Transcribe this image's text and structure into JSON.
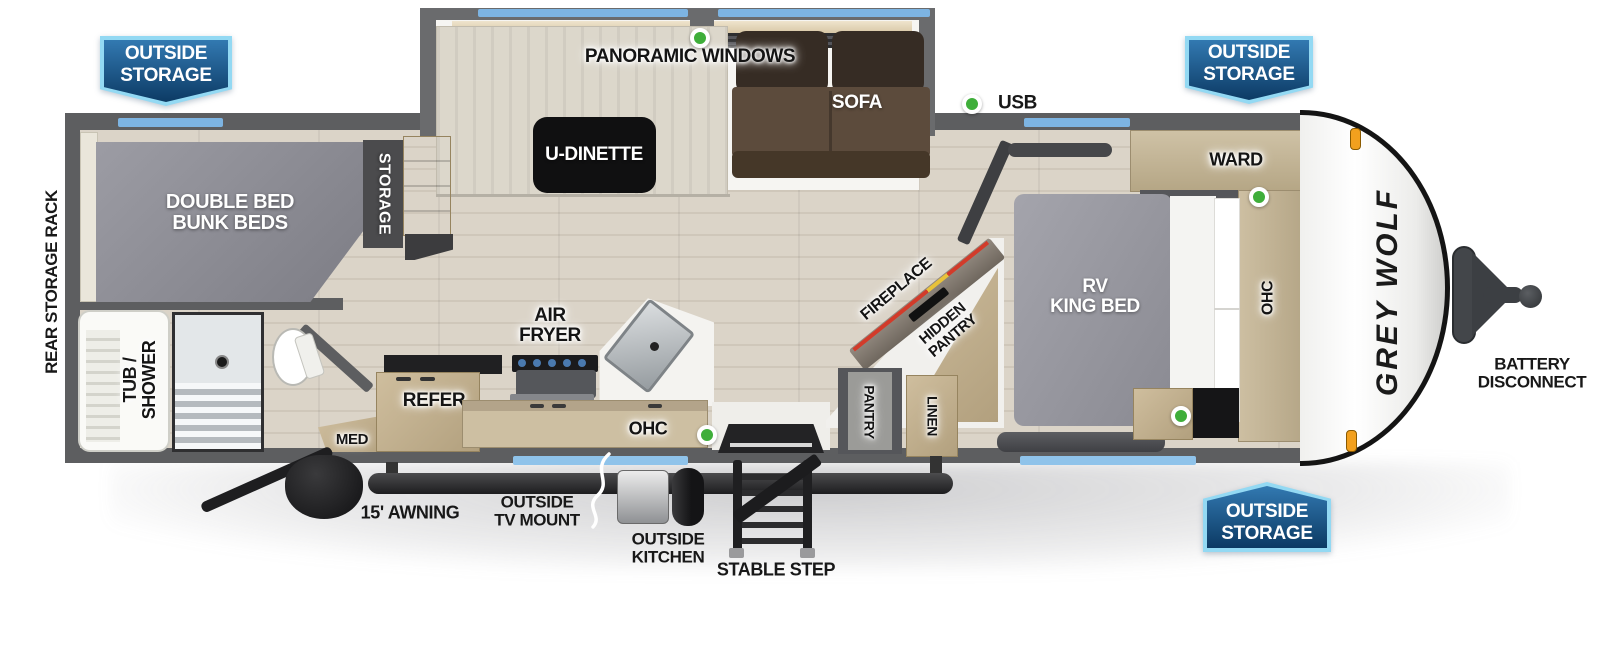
{
  "badge": {
    "line1": "OUTSIDE",
    "line2": "STORAGE"
  },
  "exterior": {
    "rear_storage_rack": "REAR STORAGE RACK",
    "awning": "15' AWNING",
    "tv_mount_l1": "OUTSIDE",
    "tv_mount_l2": "TV MOUNT",
    "kitchen_l1": "OUTSIDE",
    "kitchen_l2": "KITCHEN",
    "stable_step": "STABLE STEP",
    "battery_l1": "BATTERY",
    "battery_l2": "DISCONNECT",
    "brand": "GREY WOLF",
    "usb": "USB"
  },
  "interior": {
    "bunks_l1": "DOUBLE BED",
    "bunks_l2": "BUNK BEDS",
    "storage": "STORAGE",
    "tub_l1": "TUB /",
    "tub_l2": "SHOWER",
    "med": "MED",
    "refer": "REFER",
    "air_l1": "AIR",
    "air_l2": "FRYER",
    "ohc_kitchen": "OHC",
    "dinette": "U-DINETTE",
    "panoramic": "PANORAMIC WINDOWS",
    "sofa": "SOFA",
    "fireplace": "FIREPLACE",
    "hidden_l1": "HIDDEN",
    "hidden_l2": "PANTRY",
    "pantry": "PANTRY",
    "linen": "LINEN",
    "ward": "WARD",
    "shelf": "SHELF",
    "bed_l1": "RV",
    "bed_l2": "KING BED",
    "ohc_bedroom": "OHC"
  },
  "colors": {
    "wall": "#5d5e60",
    "window_blue": "#7db4e2",
    "badge_border": "#93d9f3",
    "badge_fill_top": "#3279b1",
    "badge_fill_bottom": "#0c3a64",
    "green_marker": "#3fae3a",
    "marker_light_orange": "#f2a01e",
    "sofa_brown": "#5c4b3c",
    "mattress_gray": "#8e8e96",
    "cabinet_wood": "#c3b191"
  }
}
